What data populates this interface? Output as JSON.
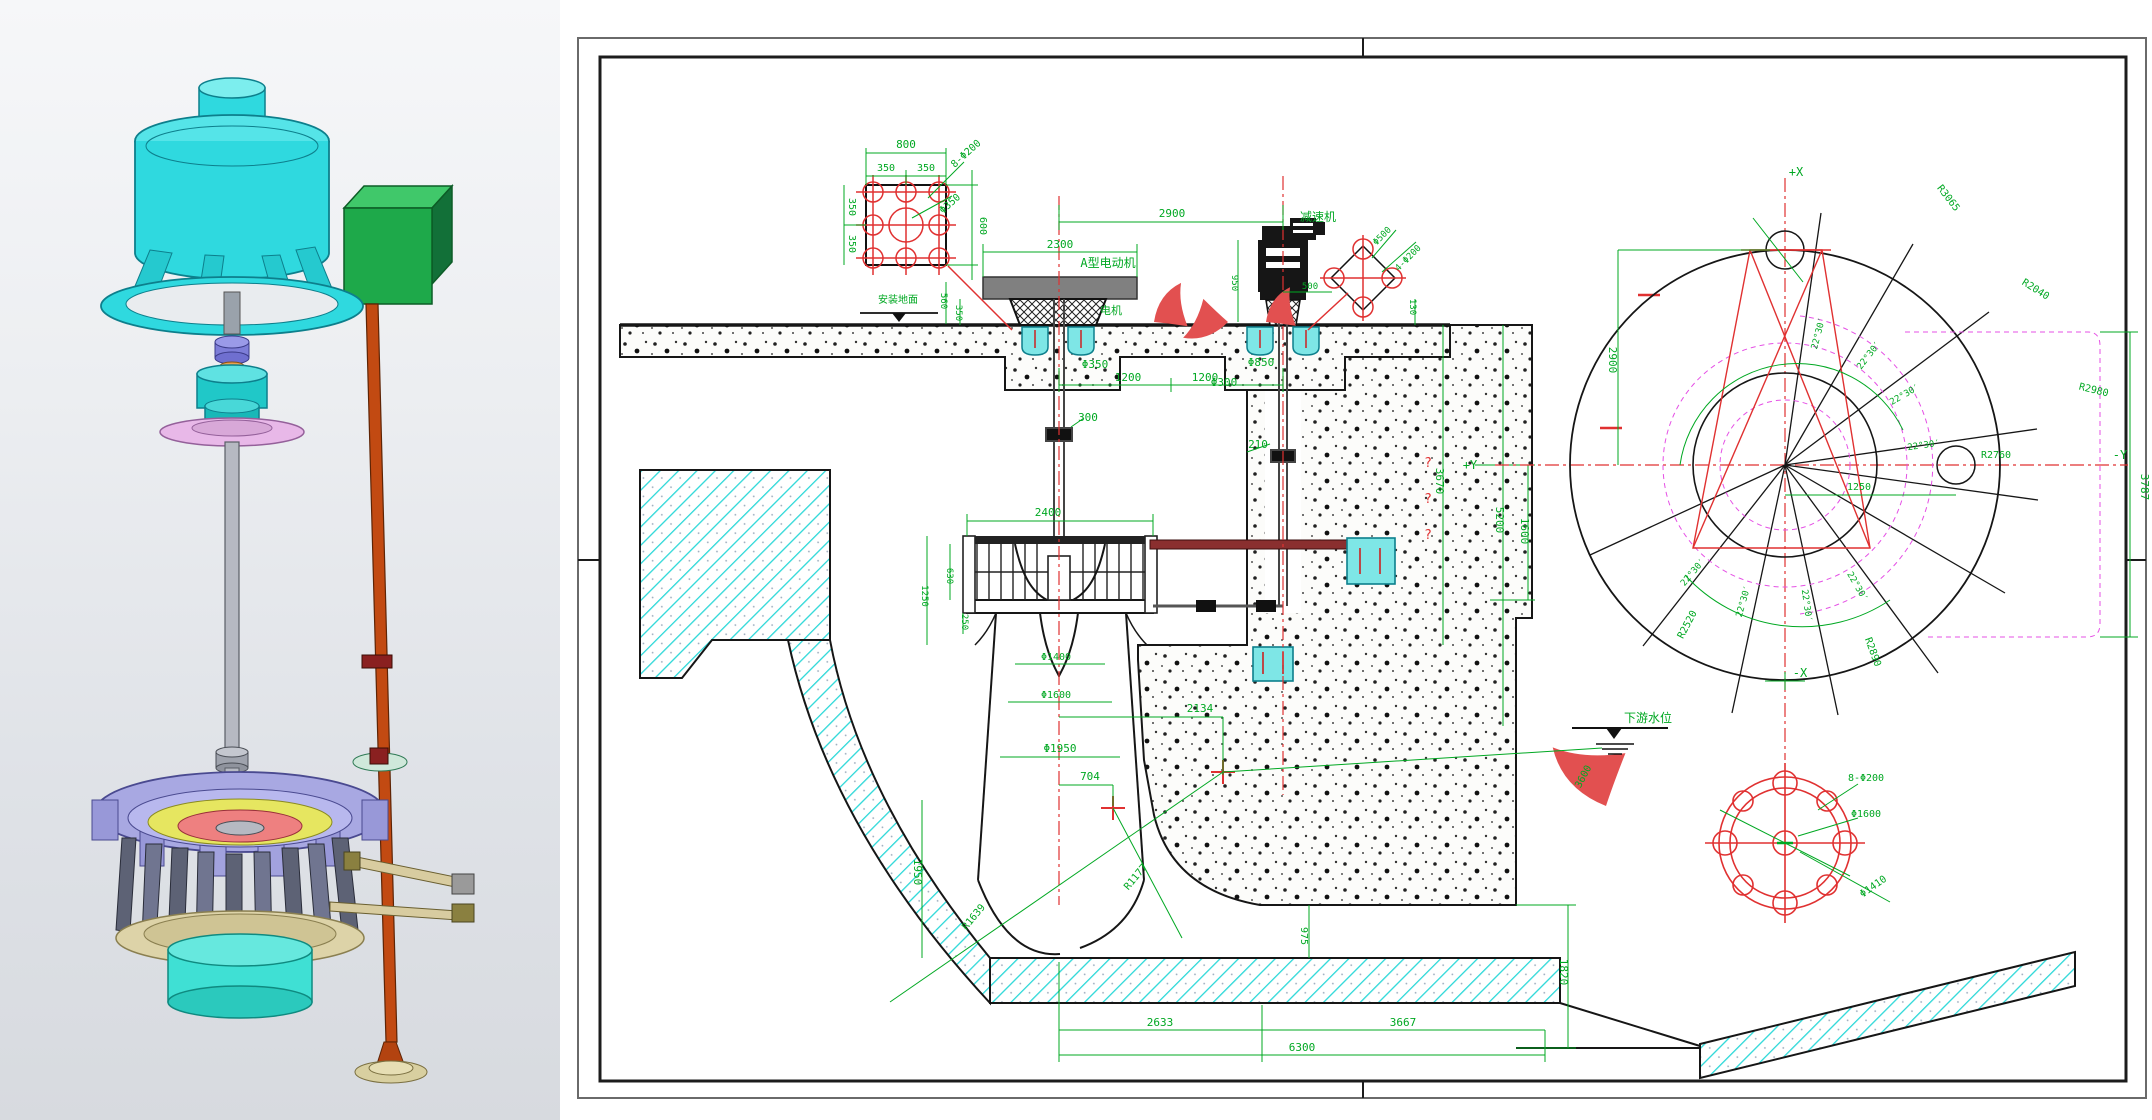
{
  "colors": {
    "green": "#00a822",
    "red": "#e03131",
    "magenta": "#e550e5",
    "cyan": "#2bd8d8",
    "dark_red": "#8a2f2f",
    "black": "#161616",
    "model_teal": "#2fd9df",
    "model_green_box": "#1ea94a",
    "model_rod_orange": "#c24a12",
    "model_lavender": "#a8a8e2"
  },
  "drawing": {
    "labels": [
      {
        "t": "800",
        "x": 346,
        "y": 148
      },
      {
        "t": "350",
        "x": 326,
        "y": 171,
        "s": 10
      },
      {
        "t": "350",
        "x": 366,
        "y": 171,
        "s": 10
      },
      {
        "t": "8-Φ200",
        "x": 408,
        "y": 156,
        "r": -42,
        "s": 10
      },
      {
        "t": "Φ350",
        "x": 392,
        "y": 206,
        "r": -42,
        "s": 10
      },
      {
        "t": "600",
        "x": 420,
        "y": 226,
        "r": 90,
        "s": 10
      },
      {
        "t": "350",
        "x": 289,
        "y": 207,
        "r": 90,
        "s": 10
      },
      {
        "t": "350",
        "x": 289,
        "y": 244,
        "r": 90,
        "s": 10
      },
      {
        "t": "2900",
        "x": 612,
        "y": 217
      },
      {
        "t": "2300",
        "x": 500,
        "y": 248
      },
      {
        "t": "A型电动机",
        "x": 548,
        "y": 267,
        "s": 12
      },
      {
        "t": "电机",
        "x": 551,
        "y": 314,
        "s": 11
      },
      {
        "t": "560",
        "x": 381,
        "y": 301,
        "r": 90,
        "s": 9
      },
      {
        "t": "350",
        "x": 396,
        "y": 313,
        "r": 90,
        "s": 9
      },
      {
        "t": "Φ350",
        "x": 535,
        "y": 368
      },
      {
        "t": "1200",
        "x": 568,
        "y": 381
      },
      {
        "t": "1200",
        "x": 645,
        "y": 381
      },
      {
        "t": "Φ850",
        "x": 701,
        "y": 366
      },
      {
        "t": "Φ300",
        "x": 664,
        "y": 386
      },
      {
        "t": "300",
        "x": 528,
        "y": 421
      },
      {
        "t": "210",
        "x": 698,
        "y": 448
      },
      {
        "t": "2400",
        "x": 488,
        "y": 516
      },
      {
        "t": "630",
        "x": 387,
        "y": 576,
        "r": 90,
        "s": 9
      },
      {
        "t": "1250",
        "x": 362,
        "y": 596,
        "r": 90,
        "s": 9
      },
      {
        "t": "250",
        "x": 402,
        "y": 622,
        "r": 90,
        "s": 9
      },
      {
        "t": "Φ1400",
        "x": 496,
        "y": 660,
        "s": 10
      },
      {
        "t": "Φ1600",
        "x": 496,
        "y": 698,
        "s": 10
      },
      {
        "t": "Φ1950",
        "x": 500,
        "y": 752
      },
      {
        "t": "704",
        "x": 530,
        "y": 780
      },
      {
        "t": "2134",
        "x": 640,
        "y": 712
      },
      {
        "t": "R1177",
        "x": 578,
        "y": 879,
        "r": -50,
        "s": 10
      },
      {
        "t": "R1639",
        "x": 416,
        "y": 919,
        "r": -50,
        "s": 10
      },
      {
        "t": "1950",
        "x": 354,
        "y": 872,
        "r": 90
      },
      {
        "t": "2633",
        "x": 600,
        "y": 1026
      },
      {
        "t": "3667",
        "x": 843,
        "y": 1026
      },
      {
        "t": "6300",
        "x": 742,
        "y": 1051
      },
      {
        "t": "975",
        "x": 741,
        "y": 936,
        "r": 90,
        "s": 10
      },
      {
        "t": "1820",
        "x": 1000,
        "y": 972,
        "r": 90
      },
      {
        "t": "3600",
        "x": 1026,
        "y": 778,
        "r": -62,
        "s": 10
      },
      {
        "t": "下游水位",
        "x": 1088,
        "y": 722,
        "s": 12
      },
      {
        "t": "950",
        "x": 672,
        "y": 283,
        "r": 90,
        "s": 9
      },
      {
        "t": "500",
        "x": 750,
        "y": 289,
        "s": 9
      },
      {
        "t": "Φ500",
        "x": 824,
        "y": 238,
        "r": -45,
        "s": 9
      },
      {
        "t": "4-Φ200",
        "x": 850,
        "y": 260,
        "r": -45,
        "s": 9
      },
      {
        "t": "130",
        "x": 850,
        "y": 307,
        "r": 90,
        "s": 9
      },
      {
        "t": "减速机",
        "x": 758,
        "y": 221,
        "s": 12
      },
      {
        "t": "5200",
        "x": 936,
        "y": 520,
        "r": 90
      },
      {
        "t": "3670",
        "x": 876,
        "y": 481,
        "r": 90
      },
      {
        "t": "?",
        "x": 868,
        "y": 467,
        "c": "red",
        "s": 13
      },
      {
        "t": "?",
        "x": 868,
        "y": 503,
        "c": "red",
        "s": 13
      },
      {
        "t": "?",
        "x": 868,
        "y": 539,
        "c": "red",
        "s": 13
      },
      {
        "t": "1600",
        "x": 961,
        "y": 531,
        "r": 90
      },
      {
        "t": "+Y",
        "x": 910,
        "y": 469,
        "s": 12
      },
      {
        "t": "安装地面",
        "x": 338,
        "y": 303,
        "s": 10
      },
      {
        "t": "+X",
        "x": 1236,
        "y": 176,
        "s": 12
      },
      {
        "t": "-Y",
        "x": 1560,
        "y": 459,
        "s": 12
      },
      {
        "t": "-X",
        "x": 1240,
        "y": 677,
        "s": 12
      },
      {
        "t": "2900",
        "x": 1049,
        "y": 360,
        "r": 90
      },
      {
        "t": "1250",
        "x": 1299,
        "y": 490,
        "s": 10
      },
      {
        "t": "3787",
        "x": 1581,
        "y": 487,
        "r": 90
      },
      {
        "t": "R3065",
        "x": 1386,
        "y": 200,
        "r": 52,
        "s": 10
      },
      {
        "t": "R2040",
        "x": 1474,
        "y": 292,
        "r": 32,
        "s": 10
      },
      {
        "t": "R2980",
        "x": 1533,
        "y": 393,
        "r": 14,
        "s": 10
      },
      {
        "t": "R2760",
        "x": 1436,
        "y": 458,
        "s": 10
      },
      {
        "t": "R2520",
        "x": 1130,
        "y": 626,
        "r": -62,
        "s": 10
      },
      {
        "t": "R2890",
        "x": 1310,
        "y": 653,
        "r": 70,
        "s": 10
      },
      {
        "t": "22°30′",
        "x": 1261,
        "y": 334,
        "r": -75,
        "s": 9
      },
      {
        "t": "22°30′",
        "x": 1311,
        "y": 357,
        "r": -52,
        "s": 9
      },
      {
        "t": "22°30′",
        "x": 1346,
        "y": 397,
        "r": -30,
        "s": 9
      },
      {
        "t": "22°30′",
        "x": 1364,
        "y": 448,
        "r": -8,
        "s": 9
      },
      {
        "t": "22°30′",
        "x": 1295,
        "y": 588,
        "r": 60,
        "s": 9
      },
      {
        "t": "22°30′",
        "x": 1244,
        "y": 606,
        "r": 82,
        "s": 9
      },
      {
        "t": "22°30′",
        "x": 1186,
        "y": 602,
        "r": -74,
        "s": 9
      },
      {
        "t": "22°30′",
        "x": 1135,
        "y": 574,
        "r": -50,
        "s": 9
      },
      {
        "t": "8-Φ200",
        "x": 1306,
        "y": 781,
        "s": 10
      },
      {
        "t": "Φ1600",
        "x": 1306,
        "y": 817,
        "s": 10
      },
      {
        "t": "Φ1410",
        "x": 1315,
        "y": 889,
        "r": -35,
        "s": 10
      }
    ]
  }
}
